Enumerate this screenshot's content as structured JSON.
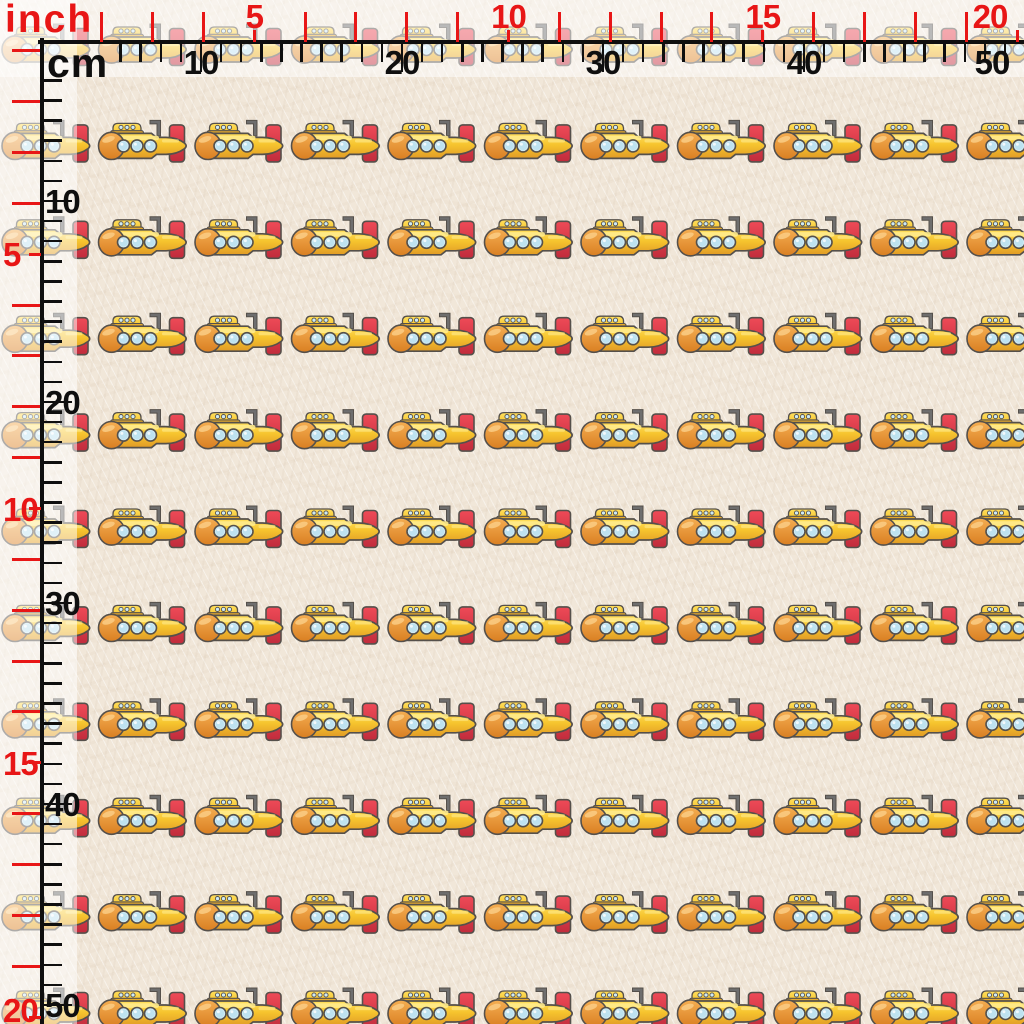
{
  "view": {
    "description_label": "",
    "width_px": 1024,
    "height_px": 1024
  },
  "rulers": {
    "inch": {
      "unit_label": "inch",
      "color": "#e81616",
      "px_per_inch": 50.85,
      "top": {
        "first_tick": 2,
        "last_tick": 20,
        "labeled_ticks": [
          5,
          10,
          15,
          20
        ]
      },
      "left": {
        "first_tick": 1,
        "last_tick": 20,
        "labeled_ticks": [
          5,
          10,
          15,
          20
        ]
      }
    },
    "cm": {
      "unit_label": "cm",
      "color": "#0f0f0f",
      "px_per_cm": 20.1,
      "top": {
        "first_tick": 6,
        "last_tick": 50,
        "labeled_ticks": [
          10,
          20,
          30,
          40,
          50
        ]
      },
      "left": {
        "first_tick": 4,
        "last_tick": 50,
        "labeled_ticks": [
          10,
          20,
          30,
          40,
          50
        ]
      }
    }
  },
  "fabric": {
    "base_color": "#f1e7d9",
    "pattern_motif": "yellow-submarine",
    "grid": {
      "columns": 11,
      "rows": 11,
      "col_spacing_px": 96.5,
      "row_spacing_px": 96.4,
      "origin_x": -0.5,
      "origin_y": 19.5
    },
    "submarine_colors": {
      "outline": "#55504b",
      "body_top": "#ffdf5e",
      "body_mid": "#f6c42e",
      "body_bottom": "#e19b26",
      "highlight": "#ffeb8c",
      "nose_top": "#f5ae52",
      "nose_bottom": "#d97f22",
      "fin_top": "#ee4a57",
      "fin_bottom": "#c12c3c",
      "tower_base": "#e8ac2c",
      "porthole": "#cdeaf5",
      "porthole_inner": "#bee2f0",
      "periscope": "#6e6e6e"
    }
  },
  "overlay": {
    "ruler_strip_color": "rgba(255,255,255,0.52)",
    "strip_size_px": 77
  }
}
